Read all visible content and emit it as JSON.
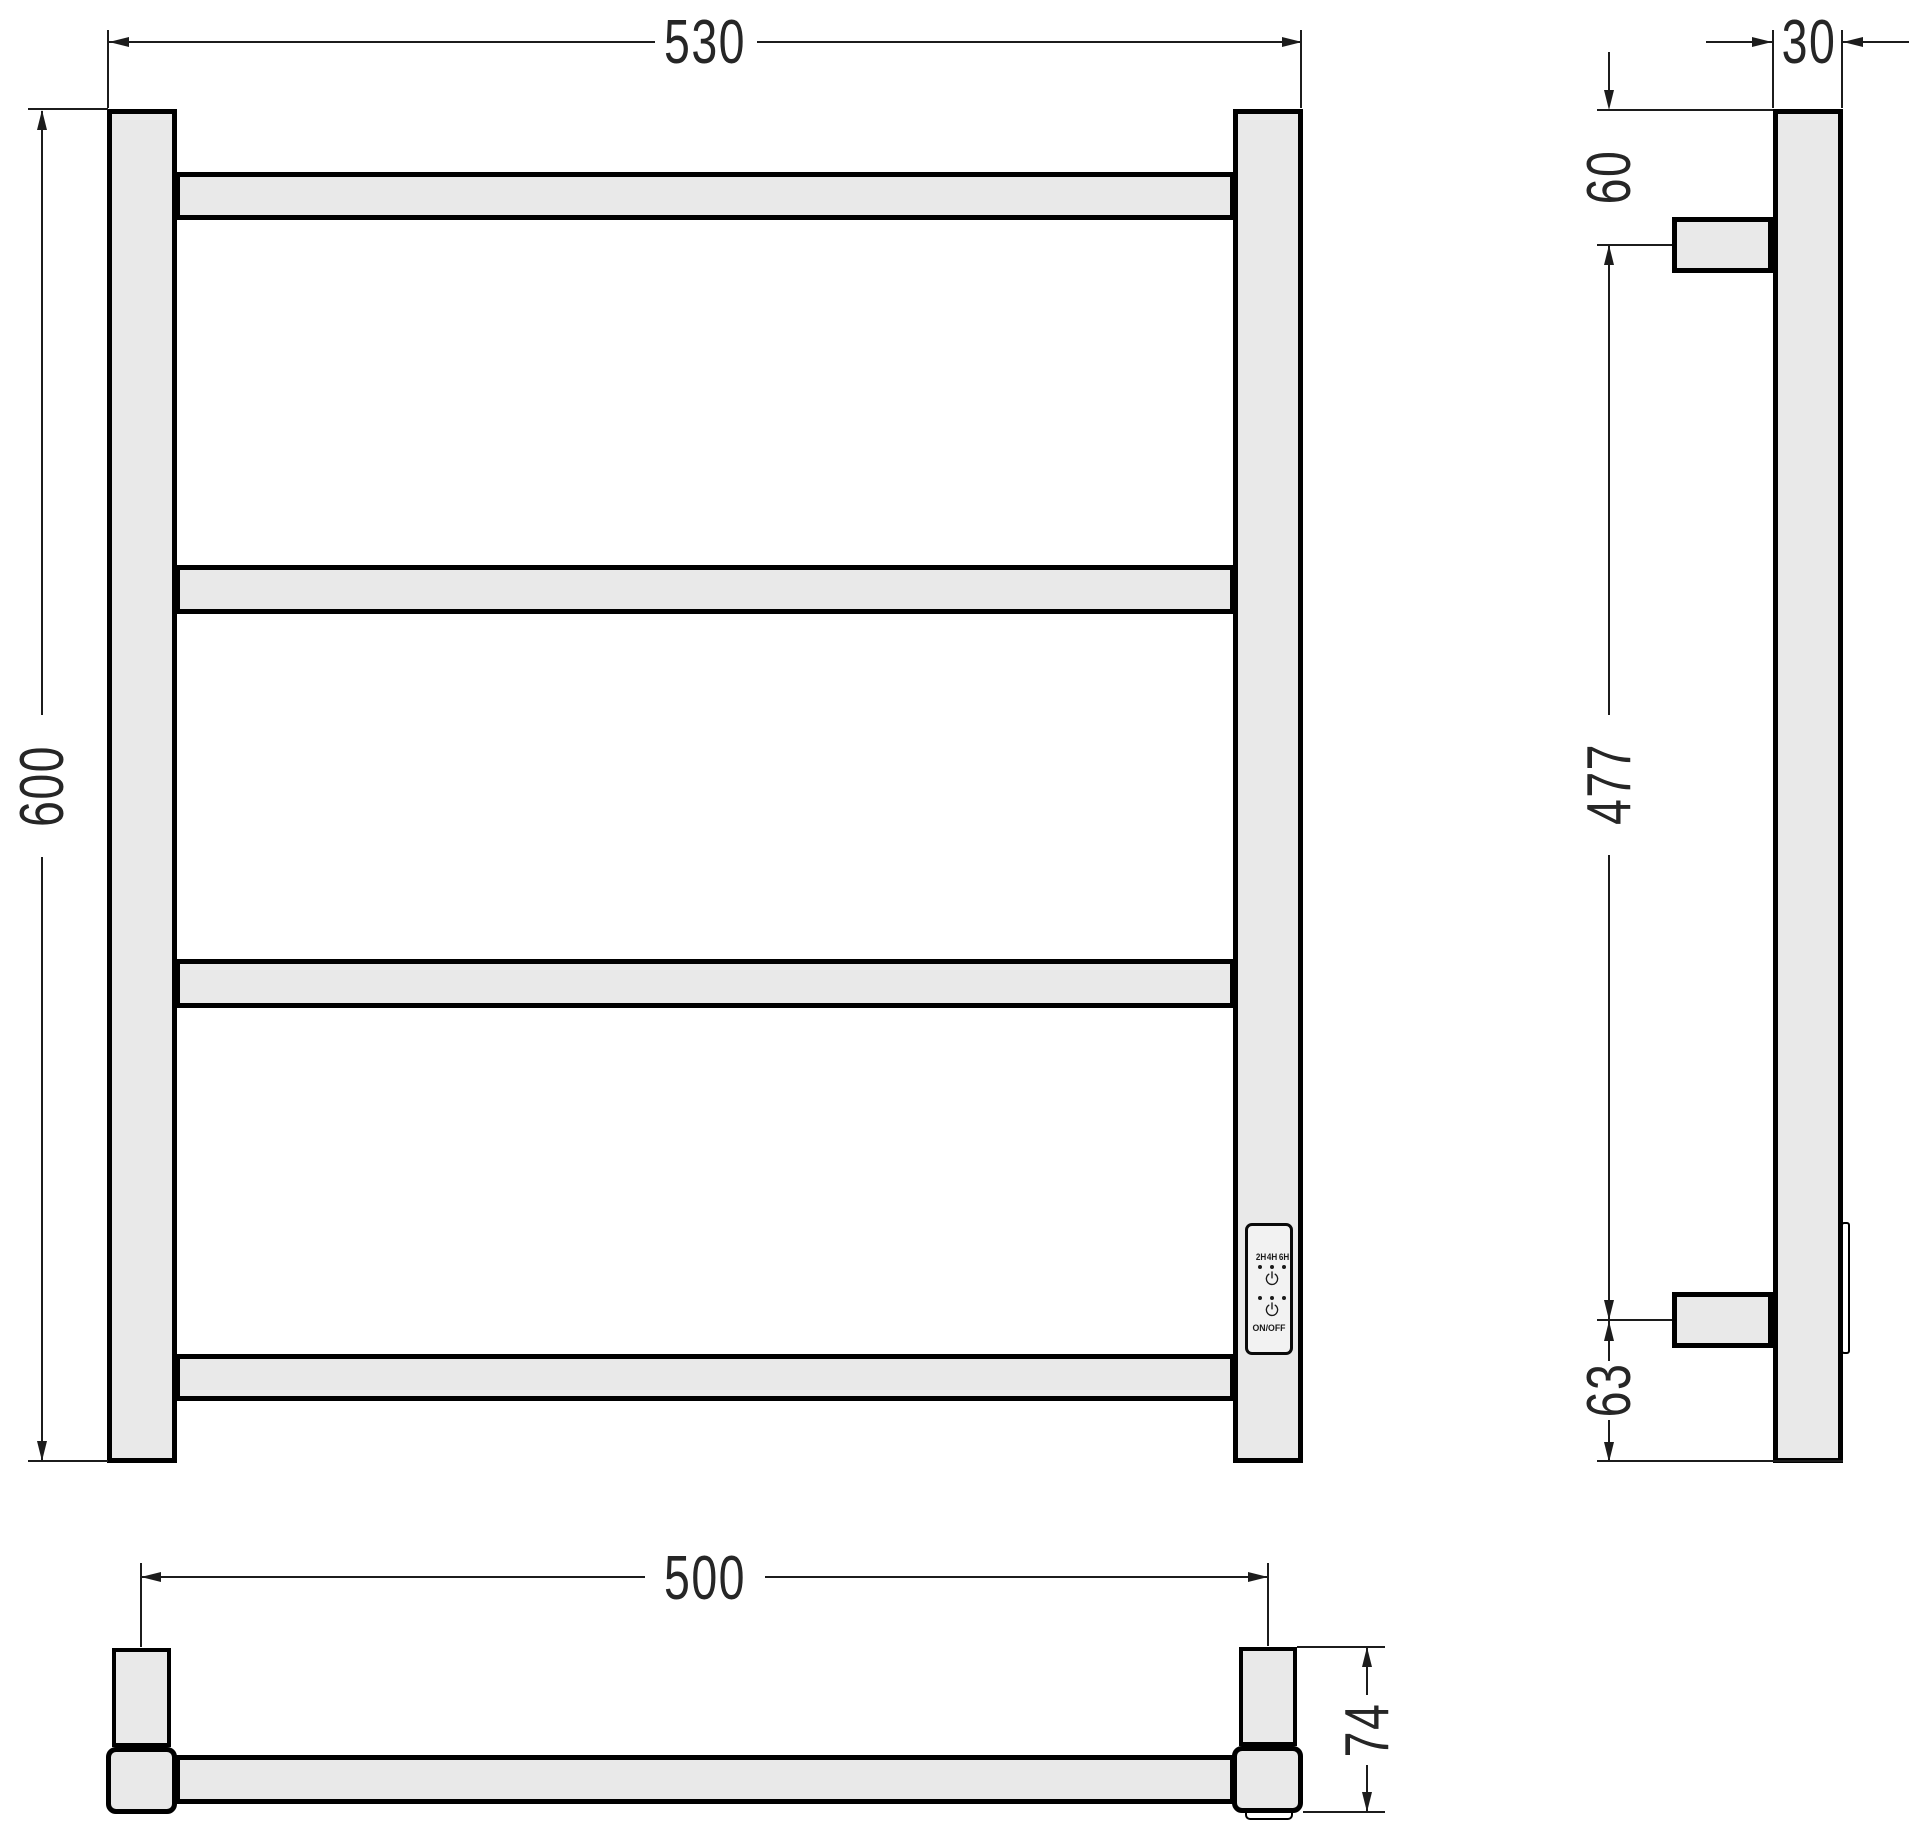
{
  "drawing": {
    "type": "towel-rail technical drawing, three orthographic views",
    "front_view": {
      "overall_width_mm": "530",
      "overall_height_mm": "600"
    },
    "side_view": {
      "tube_depth_mm": "30",
      "top_to_upper_bracket_mm": "60",
      "bracket_span_mm": "477",
      "lower_bracket_to_bottom_mm": "63"
    },
    "bottom_view": {
      "bracket_centers_mm": "500",
      "overall_depth_mm": "74"
    },
    "control_panel": {
      "timer_labels": [
        "2H",
        "4H",
        "6H"
      ],
      "power_label": "ON/OFF"
    },
    "colors": {
      "part_fill": "#e9e9e9",
      "part_outline": "#000000",
      "dimension_line": "#1c1c1c",
      "text": "#262626",
      "background": "#ffffff"
    }
  }
}
